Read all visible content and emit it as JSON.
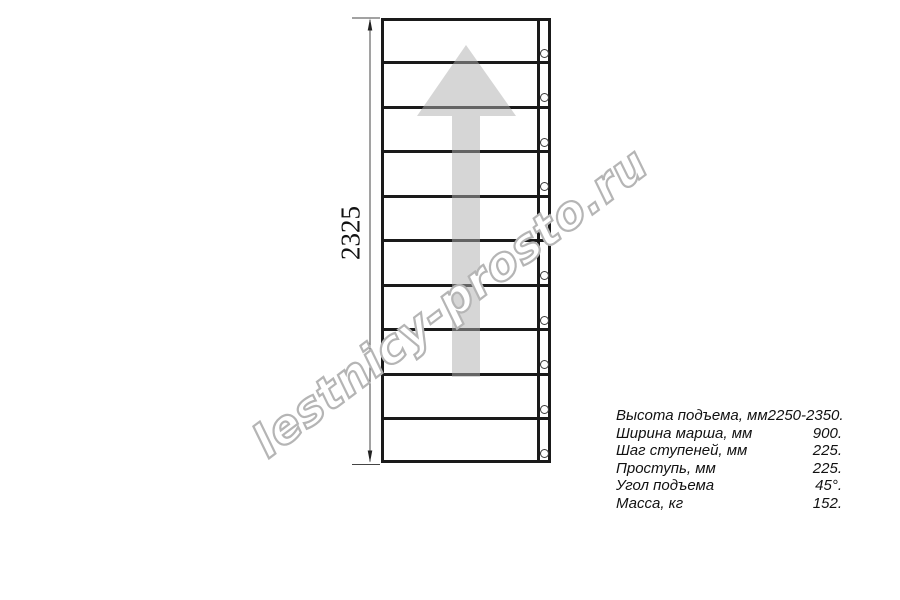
{
  "drawing": {
    "dimension_label": "2325",
    "watermark": "lestnicy-prosto.ru",
    "num_treads": 10,
    "colors": {
      "line": "#1a1a1a",
      "arrow_fill": "rgba(173,173,173,0.5)",
      "watermark_stroke": "#b5b5b5"
    }
  },
  "specs": {
    "rows": [
      {
        "label": "Высота подъема, мм",
        "value": "2250-2350."
      },
      {
        "label": "Ширина марша, мм",
        "value": "900."
      },
      {
        "label": "Шаг ступеней, мм",
        "value": "225."
      },
      {
        "label": "Проступь, мм",
        "value": "225."
      },
      {
        "label": "Угол подъема",
        "value": "45°."
      },
      {
        "label": "Масса, кг",
        "value": "152."
      }
    ]
  }
}
